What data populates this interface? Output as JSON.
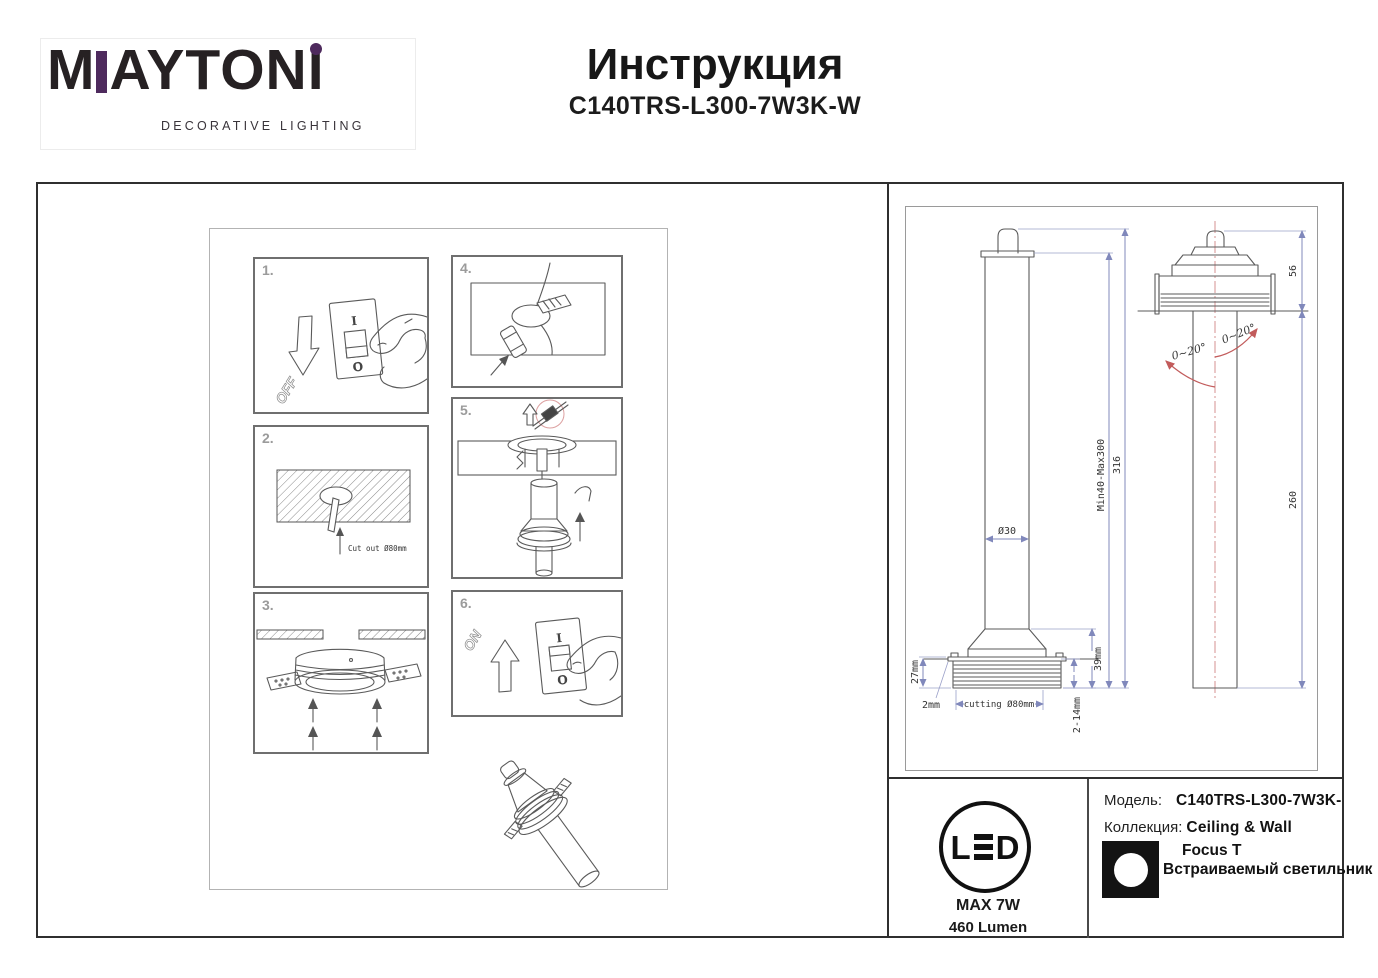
{
  "header": {
    "logo": {
      "word_start": "M",
      "word_mid": "AYTON",
      "word_end": "I",
      "subtitle": "DECORATIVE LIGHTING"
    },
    "title": "Инструкция",
    "model": "C140TRS-L300-7W3K-W"
  },
  "steps": [
    {
      "num": "1.",
      "arrow_label": "OFF",
      "switch_top": "I",
      "switch_bottom": "O"
    },
    {
      "num": "2.",
      "cut_label": "Cut out Ø80mm"
    },
    {
      "num": "3."
    },
    {
      "num": "4."
    },
    {
      "num": "5."
    },
    {
      "num": "6.",
      "arrow_label": "ON",
      "switch_top": "I",
      "switch_bottom": "O"
    }
  ],
  "tech": {
    "front": {
      "dia": "Ø30",
      "depth": "27mm",
      "trim": "2mm",
      "cutout": "cutting Ø80mm",
      "recess": "39mm",
      "ceiling": "2-14mm",
      "range": "Min40-Max300",
      "total": "316"
    },
    "side": {
      "above": "56",
      "below": "260",
      "tilt_left": "0~20°",
      "tilt_right": "0~20°"
    }
  },
  "footer": {
    "led": {
      "l": "L",
      "d": "D",
      "power": "MAX 7W",
      "lumen": "460 Lumen"
    },
    "model_label": "Модель:",
    "model_value": "C140TRS-L300-7W3K-",
    "collection_label": "Коллекция:",
    "collection_value": "Ceiling & Wall",
    "series": "Focus T",
    "type": "Встраиваемый светильник"
  },
  "colors": {
    "brand_purple": "#4e2a5d",
    "dim_line": "#8088bb",
    "accent_red": "#c25b5b"
  }
}
